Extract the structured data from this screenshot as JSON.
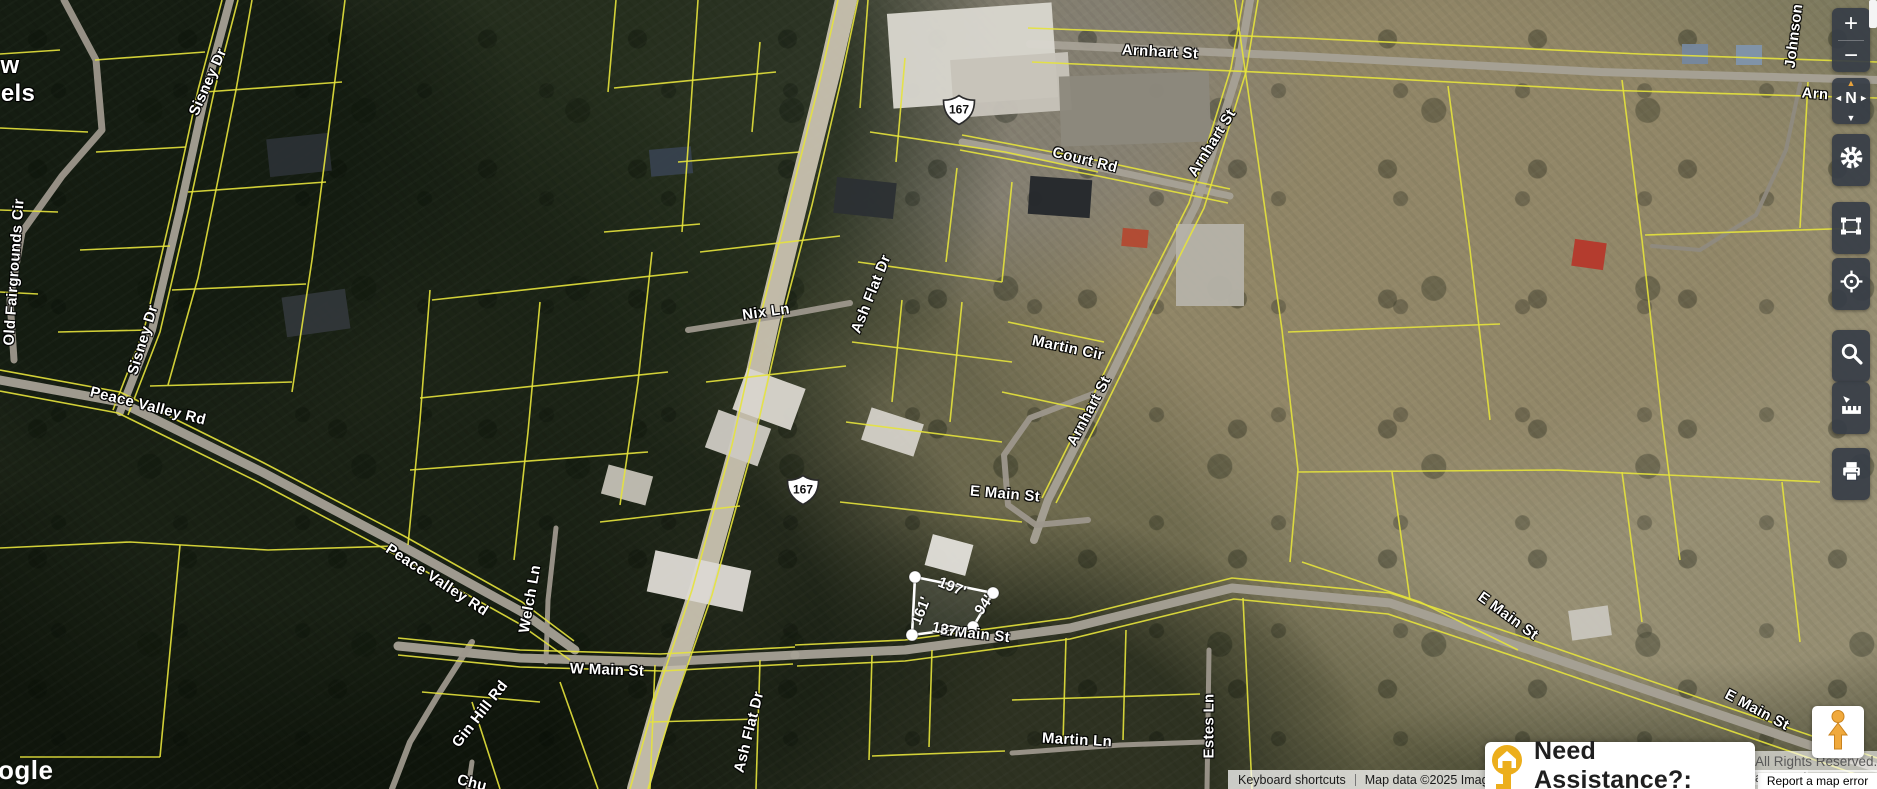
{
  "toolbar": {
    "zoom_in": "+",
    "zoom_out": "−",
    "compass": "N",
    "compass_arrows": {
      "up": "▲",
      "down": "▼",
      "left": "◄",
      "right": "►"
    }
  },
  "attribution": {
    "keyboard_shortcuts": "Keyboard shortcuts",
    "map_data": "Map data ©2025 Imag",
    "logo_partial": "ogle",
    "rights": "All Rights Reserved.",
    "rights_partial": "aranteed",
    "report_error": "Report a map error"
  },
  "assistance": {
    "label": "Need Assistance?:"
  },
  "map": {
    "parcel_line_color": "#e6e33c",
    "route_shields": [
      {
        "text": "167",
        "x": 959,
        "y": 110
      },
      {
        "text": "167",
        "x": 803,
        "y": 490
      }
    ],
    "road_labels": [
      {
        "text": "Arnhart St",
        "x": 1160,
        "y": 52,
        "rot": 3
      },
      {
        "text": "Johnson",
        "x": 1794,
        "y": 36,
        "rot": -83
      },
      {
        "text": "Court Rd",
        "x": 1085,
        "y": 160,
        "rot": 14
      },
      {
        "text": "Arnhart St",
        "x": 1212,
        "y": 143,
        "rot": -58
      },
      {
        "text": "Martin Cir",
        "x": 1068,
        "y": 348,
        "rot": 12
      },
      {
        "text": "Arnhart St",
        "x": 1089,
        "y": 411,
        "rot": -62
      },
      {
        "text": "Ash Flat Dr",
        "x": 871,
        "y": 294,
        "rot": -68
      },
      {
        "text": "Ash Flat Dr",
        "x": 749,
        "y": 732,
        "rot": -76
      },
      {
        "text": "Nix Ln",
        "x": 766,
        "y": 312,
        "rot": -8
      },
      {
        "text": "Sisney Dr",
        "x": 208,
        "y": 82,
        "rot": -66
      },
      {
        "text": "Sisney Dr",
        "x": 143,
        "y": 340,
        "rot": -73
      },
      {
        "text": "Old Fairgrounds Cir",
        "x": 14,
        "y": 272,
        "rot": -86
      },
      {
        "text": "Peace Valley Rd",
        "x": 148,
        "y": 406,
        "rot": 14
      },
      {
        "text": "Peace Valley Rd",
        "x": 437,
        "y": 580,
        "rot": 33
      },
      {
        "text": "Welch Ln",
        "x": 530,
        "y": 599,
        "rot": -80
      },
      {
        "text": "W Main St",
        "x": 607,
        "y": 670,
        "rot": 2
      },
      {
        "text": "E Main St",
        "x": 1005,
        "y": 494,
        "rot": 5
      },
      {
        "text": "E Main St",
        "x": 975,
        "y": 634,
        "rot": 6
      },
      {
        "text": "E Main St",
        "x": 1508,
        "y": 616,
        "rot": 36
      },
      {
        "text": "E Main St",
        "x": 1757,
        "y": 710,
        "rot": 28
      },
      {
        "text": "Martin Ln",
        "x": 1077,
        "y": 740,
        "rot": 3
      },
      {
        "text": "Estes Ln",
        "x": 1209,
        "y": 726,
        "rot": -90
      },
      {
        "text": "Gin Hill Rd",
        "x": 480,
        "y": 714,
        "rot": -52
      }
    ],
    "partial_labels": [
      {
        "text": "w",
        "x": 10,
        "y": 66,
        "rot": 0,
        "size": 24
      },
      {
        "text": "els",
        "x": 18,
        "y": 94,
        "rot": 0,
        "size": 24
      },
      {
        "text": "Arn",
        "x": 1815,
        "y": 94,
        "rot": 4,
        "size": 15
      },
      {
        "text": "Chu",
        "x": 472,
        "y": 783,
        "rot": 14,
        "size": 15
      }
    ],
    "selected_parcel": {
      "outline": "915,577 993,593 973,627 912,635",
      "handles": [
        [
          915,
          577
        ],
        [
          993,
          593
        ],
        [
          973,
          627
        ],
        [
          912,
          635
        ]
      ],
      "dimension_labels": [
        {
          "text": "197'",
          "x": 952,
          "y": 587,
          "rot": 22
        },
        {
          "text": "161'",
          "x": 921,
          "y": 611,
          "rot": -68
        },
        {
          "text": "94'",
          "x": 984,
          "y": 605,
          "rot": -55
        },
        {
          "text": "137'",
          "x": 946,
          "y": 630,
          "rot": 12
        }
      ]
    },
    "roads": [
      {
        "pts": "846,0 830,70 800,190 772,305 742,440 700,590 662,705 638,789",
        "w": 22,
        "c": "#c9c2b0"
      },
      {
        "pts": "1030,44 1300,56 1600,72 1877,80",
        "w": 8,
        "c": "#a7a196"
      },
      {
        "pts": "962,142 1100,168 1230,196",
        "w": 7,
        "c": "#a7a196"
      },
      {
        "pts": "1250,0 1238,70 1196,205 1148,300 1090,418 1048,500 1034,540",
        "w": 8,
        "c": "#a7a196"
      },
      {
        "pts": "1098,392 1030,418 1004,455 1008,505 1036,525 1088,520",
        "w": 6,
        "c": "#9d978c"
      },
      {
        "pts": "688,330 790,314 850,303",
        "w": 6,
        "c": "#9d978c"
      },
      {
        "pts": "230,0 206,90 180,210 152,330 120,412",
        "w": 8,
        "c": "#a7a196"
      },
      {
        "pts": "0,380 120,402 262,472 402,546 522,612 575,650",
        "w": 9,
        "c": "#a7a196"
      },
      {
        "pts": "398,646 520,658 660,662 795,655",
        "w": 9,
        "c": "#a7a196"
      },
      {
        "pts": "795,655 905,650 1070,628 1232,588 1390,603 1530,650 1700,708 1877,768",
        "w": 9,
        "c": "#a7a196"
      },
      {
        "pts": "64,0 96,60 102,130 62,176 22,232 10,300 14,360",
        "w": 7,
        "c": "#9d978c"
      },
      {
        "pts": "556,528 548,600 546,662",
        "w": 5,
        "c": "#9d978c"
      },
      {
        "pts": "472,642 440,692 410,742 392,789",
        "w": 6,
        "c": "#9d978c"
      },
      {
        "pts": "472,762 468,789",
        "w": 5,
        "c": "#9d978c"
      },
      {
        "pts": "1209,650 1207,789",
        "w": 5,
        "c": "#9d978c"
      },
      {
        "pts": "1012,753 1120,745 1205,742",
        "w": 5,
        "c": "#9d978c"
      },
      {
        "pts": "1800,84 1786,150 1756,215 1700,250 1652,246",
        "w": 4,
        "c": "#8f8a80"
      }
    ],
    "parcel_lines": [
      "252,0 236,90 218,180 198,278 168,385",
      "345,0 330,120 312,260 292,392",
      "205,92 342,82",
      "188,192 326,182",
      "172,290 306,284",
      "150,386 292,382",
      "95,60 205,52",
      "96,152 186,147",
      "80,250 170,246",
      "58,332 150,330",
      "0,54 60,50",
      "0,128 88,132",
      "0,210 58,212",
      "0,292 38,294",
      "430,290 420,420 408,545",
      "540,302 528,432 514,560",
      "652,252 638,382 620,505",
      "432,300 688,272",
      "420,398 668,372",
      "410,470 648,452",
      "600,522 740,506",
      "700,252 840,236",
      "706,382 846,366",
      "616,0 608,92",
      "698,0 690,120 682,232",
      "760,42 752,132",
      "614,88 776,72",
      "678,162 800,152",
      "604,232 700,224",
      "868,0 860,108",
      "905,58 896,162",
      "957,168 946,262",
      "1012,182 1002,282",
      "870,132 1005,152 1098,172",
      "858,262 1002,282",
      "852,342 1012,362",
      "846,422 1002,442",
      "840,502 1022,522",
      "902,300 892,402",
      "962,302 950,422",
      "1008,322 1104,342",
      "1002,392 1096,412",
      "1235,0 1258,160 1282,330 1298,470 1290,562",
      "1448,86 1470,250 1490,420",
      "1288,332 1500,324",
      "1298,472 1558,470 1820,482",
      "1622,80 1642,240 1662,420 1680,560",
      "1645,235 1862,228",
      "1808,82 1800,228",
      "1302,562 1420,602 1518,650",
      "1392,472 1410,600",
      "1622,472 1642,622",
      "1782,482 1800,642",
      "655,665 650,789",
      "760,660 756,789",
      "872,655 869,760",
      "932,650 929,747",
      "1066,638 1063,742",
      "1126,630 1123,740",
      "1243,598 1252,789",
      "650,722 758,719",
      "872,756 1005,751",
      "1012,700 1200,694",
      "422,692 540,702",
      "560,682 598,789",
      "472,702 500,789",
      "0,548 130,542 268,550 396,546",
      "180,545 160,757",
      "20,757 160,757",
      "838,0 820,80 790,200 762,310 732,445 692,590 655,700 630,789",
      "858,0 840,85 812,205 783,315 752,450 712,595 672,710 648,789",
      "795,645 905,640 1070,618 1232,578 1390,593 1532,640 1700,698 1877,758",
      "797,666 905,661 1070,639 1234,599 1388,614 1528,661 1696,719 1870,779",
      "0,370 120,392 262,462 404,536 522,602 574,641",
      "0,391 118,413 260,483 400,557 518,623 570,660",
      "1243,0 1231,68 1189,203 1141,298 1083,416 1042,498",
      "1258,0 1246,72 1204,208 1156,303 1098,421 1056,503",
      "222,0 198,90 172,210 144,330 113,410",
      "238,0 214,92 188,212 160,332 128,415",
      "1032,62 1300,74 1600,90 1877,98",
      "1028,28 1300,38 1640,54 1877,62",
      "962,135 1100,161 1230,189",
      "960,150 1098,176 1228,203",
      "398,638 520,650 660,654 795,647",
      "398,655 520,667 662,671 793,664"
    ],
    "buildings": [
      [
        890,
        8,
        165,
        95,
        "#d9d6ce",
        -4
      ],
      [
        952,
        56,
        118,
        58,
        "#c7c3b9",
        -4
      ],
      [
        1060,
        74,
        150,
        70,
        "#8d887d",
        -2
      ],
      [
        1176,
        224,
        68,
        82,
        "#b5b2a8",
        0
      ],
      [
        1029,
        178,
        62,
        38,
        "#24282c",
        4
      ],
      [
        1122,
        229,
        26,
        18,
        "#b34a32",
        5
      ],
      [
        1573,
        241,
        32,
        27,
        "#b5392c",
        8
      ],
      [
        1682,
        44,
        26,
        20,
        "#76879d",
        0
      ],
      [
        1736,
        45,
        26,
        20,
        "#8094ab",
        0
      ],
      [
        738,
        377,
        62,
        44,
        "#d8d5cd",
        20
      ],
      [
        710,
        418,
        56,
        40,
        "#ccc9c1",
        20
      ],
      [
        928,
        539,
        42,
        32,
        "#e1dfd9",
        15
      ],
      [
        650,
        560,
        98,
        42,
        "#dcd9d2",
        12
      ],
      [
        268,
        136,
        62,
        38,
        "#2b3034",
        -6
      ],
      [
        284,
        293,
        64,
        40,
        "#313639",
        -8
      ],
      [
        650,
        148,
        42,
        27,
        "#37424d",
        -5
      ],
      [
        1570,
        608,
        40,
        30,
        "#c8c5bc",
        -8
      ],
      [
        604,
        470,
        46,
        30,
        "#c2beb4",
        15
      ],
      [
        835,
        180,
        60,
        36,
        "#2c3033",
        6
      ],
      [
        865,
        415,
        55,
        34,
        "#d2cfc7",
        18
      ]
    ]
  }
}
